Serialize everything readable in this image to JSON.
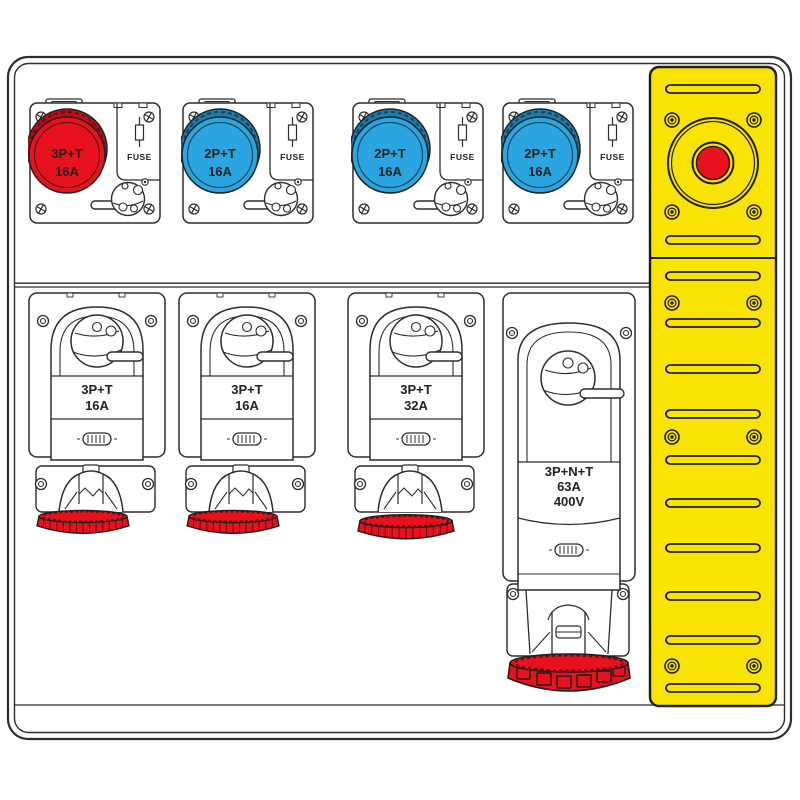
{
  "device": {
    "name": "industrial-distribution-board"
  },
  "colors": {
    "socket_red": "#e8121f",
    "socket_red_dark": "#bb0e18",
    "socket_blue": "#2aa5df",
    "socket_blue_dark": "#1c7cb0",
    "panel_yellow": "#f9e300",
    "estop_red": "#e8121f",
    "outline": "#2d2d2d"
  },
  "top_row": {
    "units": [
      {
        "label_line1": "3P+T",
        "label_line2": "16A",
        "fuse_label": "FUSE"
      },
      {
        "label_line1": "2P+T",
        "label_line2": "16A",
        "fuse_label": "FUSE"
      },
      {
        "label_line1": "2P+T",
        "label_line2": "16A",
        "fuse_label": "FUSE"
      },
      {
        "label_line1": "2P+T",
        "label_line2": "16A",
        "fuse_label": "FUSE"
      }
    ]
  },
  "bottom_row": {
    "units": [
      {
        "label_line1": "3P+T",
        "label_line2": "16A"
      },
      {
        "label_line1": "3P+T",
        "label_line2": "16A"
      },
      {
        "label_line1": "3P+T",
        "label_line2": "32A"
      },
      {
        "label_line1": "3P+N+T",
        "label_line2": "63A",
        "label_line3": "400V"
      }
    ]
  }
}
